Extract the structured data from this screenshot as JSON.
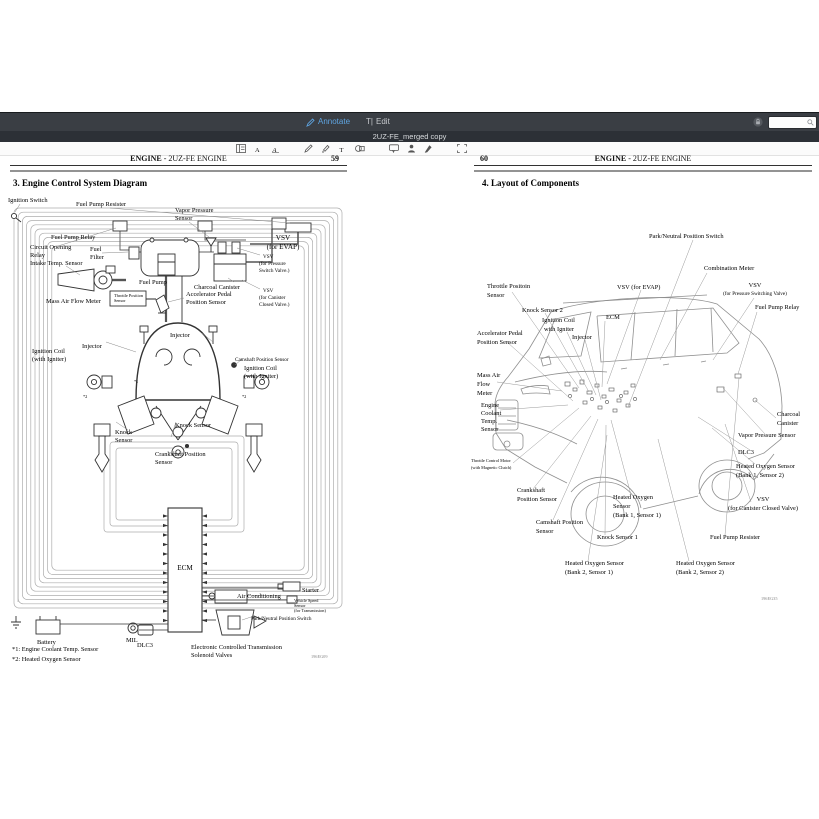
{
  "window": {
    "toolbar": {
      "annotate_label": "Annotate",
      "edit_label": "Edit",
      "edit_icon_glyph": "T|"
    },
    "doc_title": "2UZ-FE_merged copy",
    "search": {
      "placeholder": "",
      "value": ""
    },
    "toolbar_icons": [
      "sidebar-thumbnails-icon",
      "text-style-icon",
      "font-style-icon",
      "pencil-icon",
      "highlighter-icon",
      "text-tool-icon",
      "shapes-icon",
      "note-icon",
      "signature-icon",
      "draw-pen-icon",
      "select-area-icon",
      "search-icon",
      "lock-icon",
      "annotate-pencil-icon"
    ],
    "colors": {
      "accent_blue": "#5ea4e0",
      "toolbar_bg": "#3a3e44",
      "titlebar_bg": "#2c3036"
    }
  },
  "page59": {
    "header": {
      "title_bold": "ENGINE",
      "title_rest": " - 2UZ-FE ENGINE",
      "page_number": "59"
    },
    "section_title": "3.  Engine Control System Diagram",
    "labels": [
      [
        "Ignition Switch"
      ],
      [
        "Fuel Pump Resister"
      ],
      [
        "Vapor Pressure",
        "Sensor"
      ],
      [
        "VSV",
        "(for EVAP)"
      ],
      [
        "Fuel Pump Relay"
      ],
      [
        "Circuit Opening",
        "Relay"
      ],
      [
        "Fuel",
        "Filter"
      ],
      [
        "Intake Temp. Sensor"
      ],
      [
        "Fuel Pump"
      ],
      [
        "Charcoal Canister"
      ],
      [
        "VSV",
        "(for Pressure",
        "Switch Valve.)"
      ],
      [
        "VSV",
        "(for Canister",
        "Closed Valve.)"
      ],
      [
        "Mass Air Flow Meter"
      ],
      [
        "Throttle Position",
        "Sensor"
      ],
      [
        "Accelerator Pedal",
        "Position Sensor"
      ],
      [
        "Injector"
      ],
      [
        "Injector"
      ],
      [
        "Ignition Coil",
        "(with Igniter)"
      ],
      [
        "Camshaft Position Sensor"
      ],
      [
        "Ignition Coil",
        "(with Igniter)"
      ],
      [
        "Knock Sensor"
      ],
      [
        "Knock",
        "Sensor"
      ],
      [
        "Crankshaft Position",
        "Sensor"
      ],
      [
        "ECM"
      ],
      [
        "Starter"
      ],
      [
        "Air Conditioning"
      ],
      [
        "Vehicle Speed",
        "Sensor",
        "(for Transmission)"
      ],
      [
        "Park/Neutral Position Switch"
      ],
      [
        "MIL"
      ],
      [
        "Battery"
      ],
      [
        "DLC3"
      ],
      [
        "Electronic Controlled Transmission",
        "Solenoid Valves"
      ]
    ],
    "mark1": "*1",
    "mark2": "*2",
    "footnote1": "*1: Engine Coolant Temp. Sensor",
    "footnote2": "*2: Heated Oxygen Sensor",
    "figure_code": "196EG09"
  },
  "page60": {
    "header": {
      "page_number": "60",
      "title_bold": "ENGINE",
      "title_rest": " - 2UZ-FE ENGINE"
    },
    "section_title": "4.  Layout of Components",
    "labels": [
      [
        "Park/Neutral Position Switch"
      ],
      [
        "Combination Meter"
      ],
      [
        "VSV (for EVAP)"
      ],
      [
        "VSV",
        "(for Pressure Switching Valve)"
      ],
      [
        "Throttle Positoin",
        "Sensor"
      ],
      [
        "Fuel Pump Relay"
      ],
      [
        "Knock Sensor 2"
      ],
      [
        "ECM"
      ],
      [
        "Ignition Coil",
        "with Igniter"
      ],
      [
        "Injector"
      ],
      [
        "Accelerator Pedal",
        "Position Sensor"
      ],
      [
        "Mass Air",
        "Flow",
        "Meter"
      ],
      [
        "Engine",
        "Coolant",
        "Temp.",
        "Sensor"
      ],
      [
        "Charcoal",
        "Canister"
      ],
      [
        "Vapor Pressure Sensor"
      ],
      [
        "DLC3"
      ],
      [
        "Throttle Control Motor",
        "(with Magnetic Clutch)"
      ],
      [
        "Heated Oxygen Sensor",
        "(Bank 1, Sensor 2)"
      ],
      [
        "Crankshaft",
        "Position Sensor"
      ],
      [
        "Heated Oxygen",
        "Sensor",
        "(Bank 1, Sensor 1)"
      ],
      [
        "VSV",
        "(for Canister Closed Valve)"
      ],
      [
        "Camshaft Position",
        "Sensor"
      ],
      [
        "Knock Sensor 1"
      ],
      [
        "Fuel Pump Resister"
      ],
      [
        "Heated Oxygen Sensor",
        "(Bank 2, Sensor 1)"
      ],
      [
        "Heated Oxygen Sensor",
        "(Bank 2, Sensor 2)"
      ]
    ],
    "figure_code": "196EG35"
  }
}
